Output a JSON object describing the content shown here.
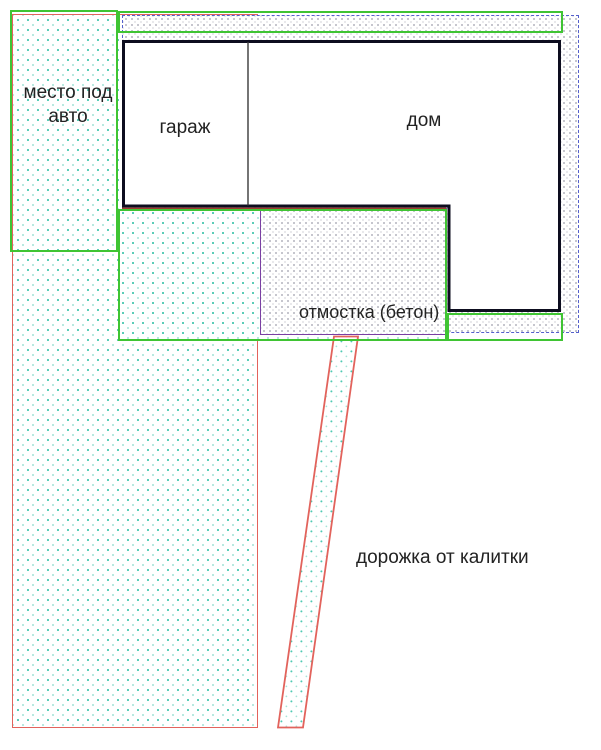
{
  "plan": {
    "labels": {
      "parking_line1": "место под",
      "parking_line2": "авто",
      "garage": "гараж",
      "house": "дом",
      "blind_area": "отмостка (бетон)",
      "walkway": "дорожка от калитки"
    },
    "colors": {
      "lawn_outline_green": "#3fc433",
      "path_outline_red": "#e2635c",
      "blind_area_dashed_blue": "#5560cc",
      "concrete_outline_purple": "#7a3fa3",
      "building_outline_black": "#0d0d1f",
      "lawn_dot_teal": "#4ec9b2",
      "concrete_dot_gray": "#b3b3bd",
      "label_text": "#222222"
    }
  }
}
